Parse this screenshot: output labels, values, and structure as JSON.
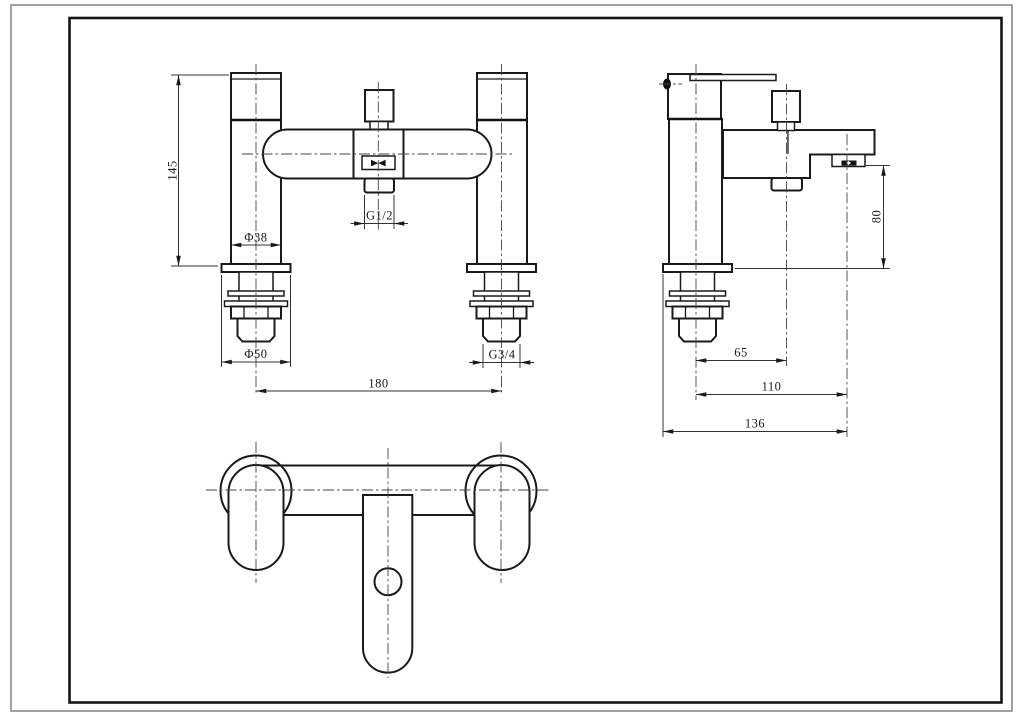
{
  "drawing": {
    "front_view": {
      "dim_height": "145",
      "dim_pillar_diameter": "Φ38",
      "dim_base_diameter": "Φ50",
      "dim_diverter_thread": "G1/2",
      "dim_inlet_thread": "G3/4",
      "dim_hole_centres": "180"
    },
    "side_view": {
      "dim_outlet_height": "80",
      "dim_diverter_offset": "65",
      "dim_spout_reach": "110",
      "dim_overall_depth": "136"
    },
    "colors": {
      "line": "#1a1a1a",
      "dimension_line": "#333333",
      "centerline": "#454545",
      "outer_border": "#8a8a8a",
      "background": "#ffffff"
    }
  }
}
